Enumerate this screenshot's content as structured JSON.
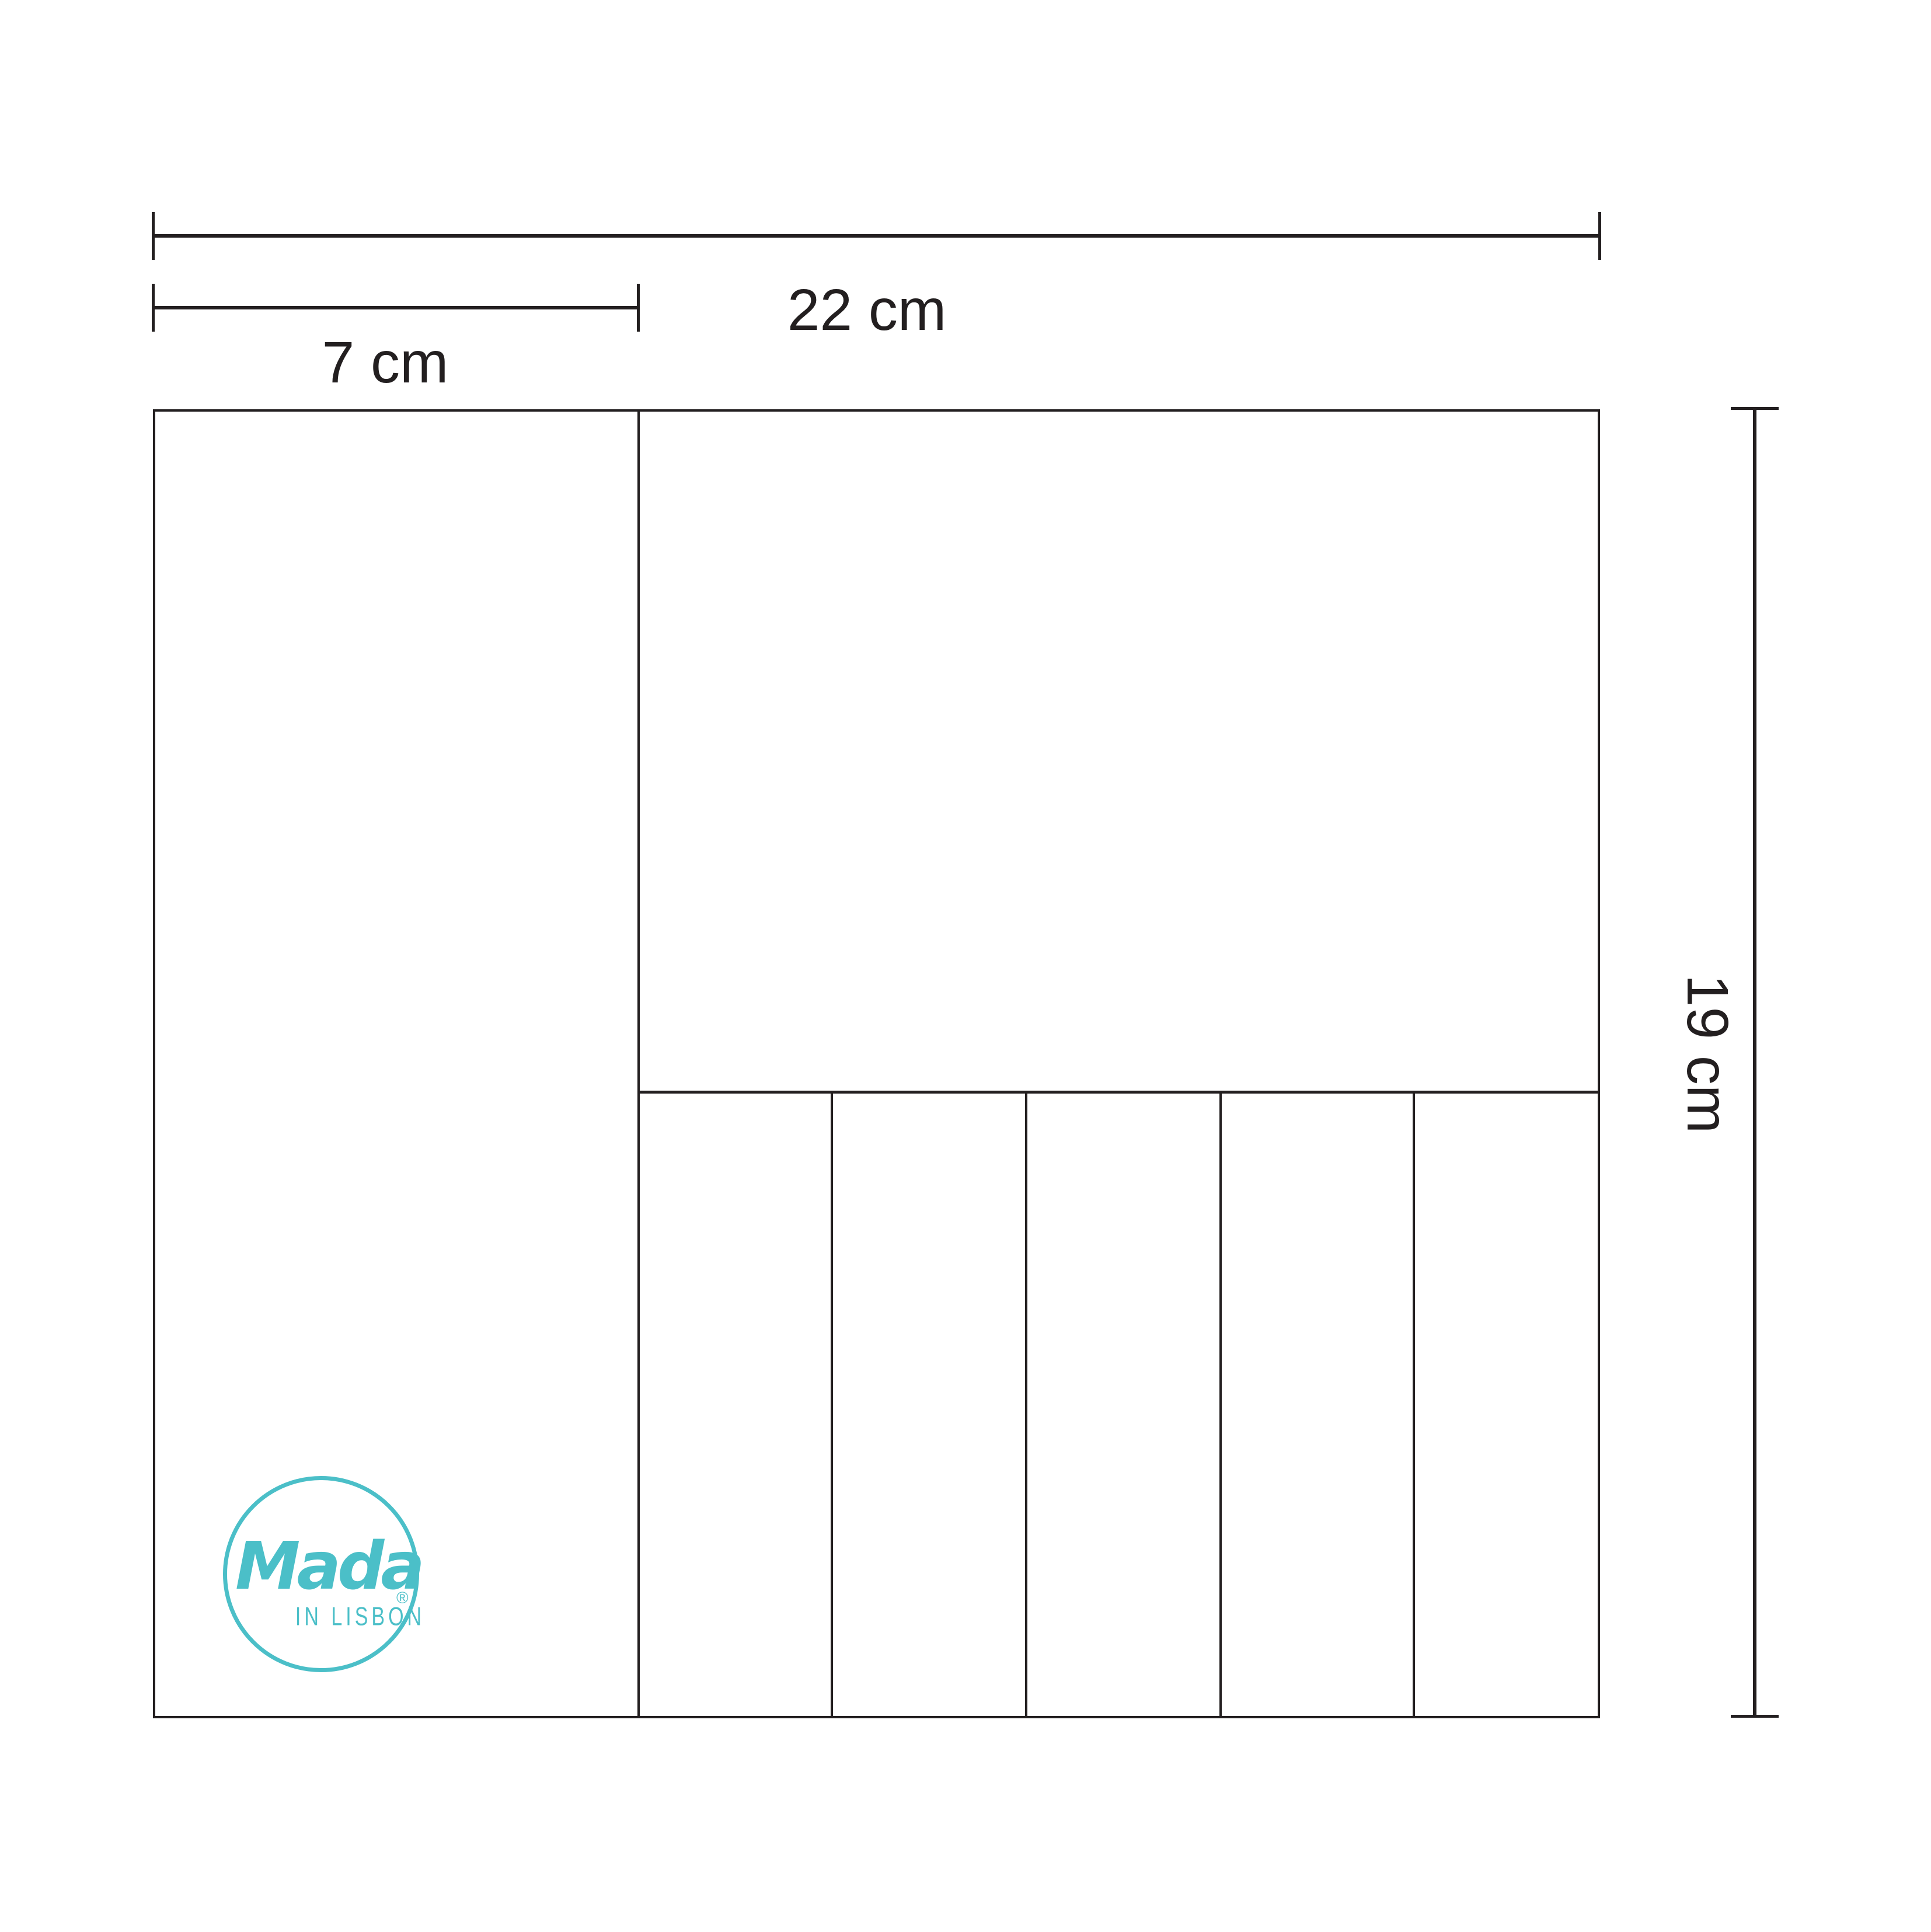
{
  "colors": {
    "line": "#231F20",
    "accent": "#4BBFC8",
    "background": "#FFFFFF"
  },
  "dimensions": {
    "width": {
      "label": "22 cm"
    },
    "left_section": {
      "label": "7 cm"
    },
    "height": {
      "label": "19 cm"
    }
  },
  "logo": {
    "brand": "Mada",
    "registered": "®",
    "subtitle": "IN LISBON"
  }
}
